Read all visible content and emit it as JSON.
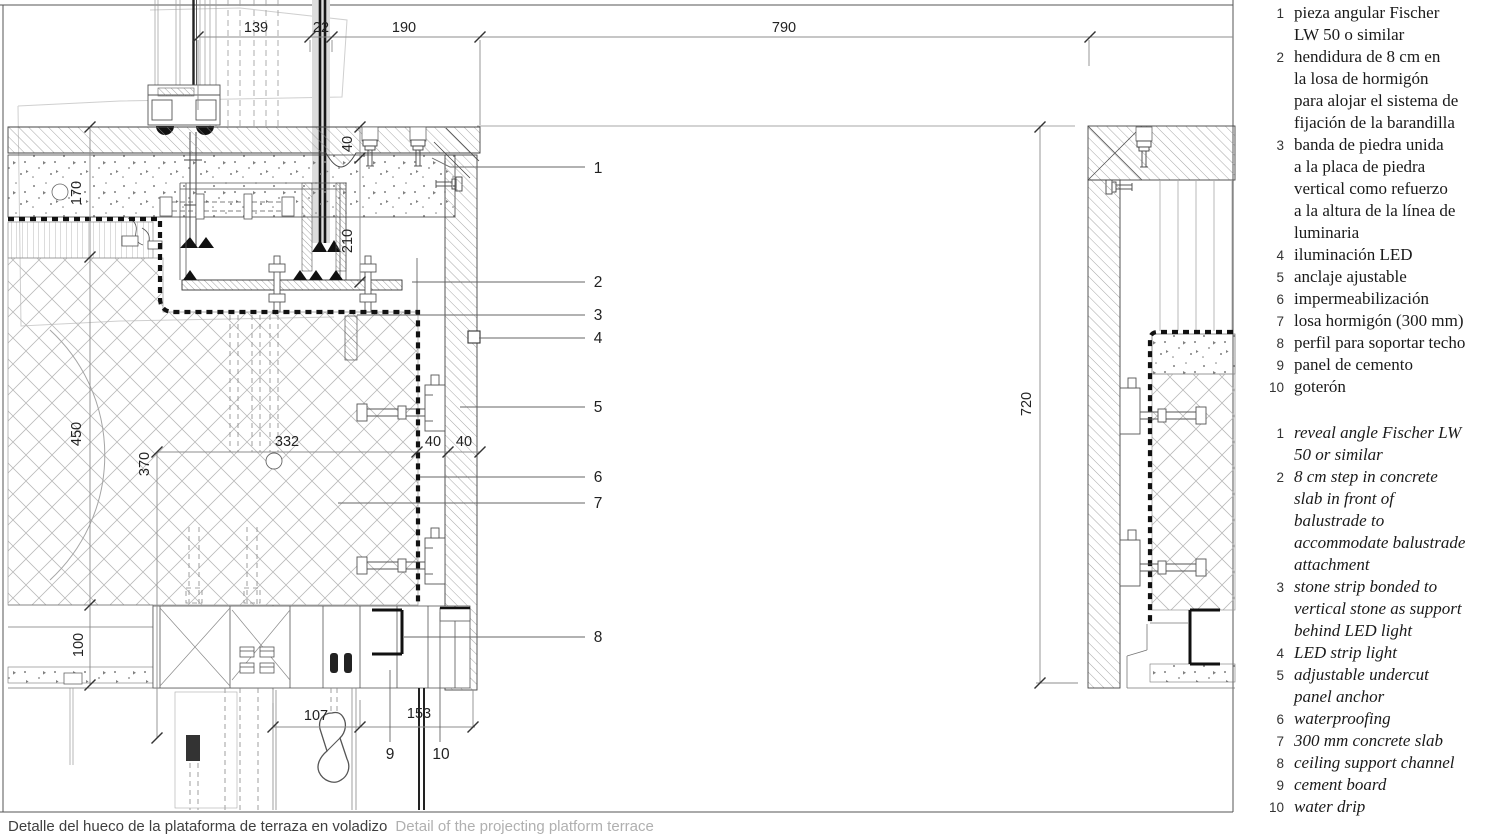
{
  "drawing": {
    "dims": {
      "t139": "139",
      "t22": "22",
      "t190": "190",
      "t790": "790",
      "v40": "40",
      "v210": "210",
      "v170": "170",
      "v450": "450",
      "v370": "370",
      "v100": "100",
      "v720": "720",
      "m332": "332",
      "m40a": "40",
      "m40b": "40",
      "b107": "107",
      "b153": "153"
    },
    "callouts": {
      "c1": "1",
      "c2": "2",
      "c3": "3",
      "c4": "4",
      "c5": "5",
      "c6": "6",
      "c7": "7",
      "c8": "8",
      "c9": "9",
      "c10": "10"
    }
  },
  "legend": {
    "es": {
      "items": [
        {
          "num": "1",
          "text": "pieza angular Fischer\nLW 50 o similar"
        },
        {
          "num": "2",
          "text": "hendidura de 8 cm en\nla losa de hormigón\npara alojar el sistema de\nfijación de la barandilla"
        },
        {
          "num": "3",
          "text": "banda de piedra unida\na la placa de piedra\nvertical como refuerzo\na la altura de la línea de\nluminaria"
        },
        {
          "num": "4",
          "text": "iluminación LED"
        },
        {
          "num": "5",
          "text": "anclaje ajustable"
        },
        {
          "num": "6",
          "text": "impermeabilización"
        },
        {
          "num": "7",
          "text": "losa hormigón (300 mm)"
        },
        {
          "num": "8",
          "text": "perfil para soportar techo"
        },
        {
          "num": "9",
          "text": "panel de cemento"
        },
        {
          "num": "10",
          "text": "goterón"
        }
      ]
    },
    "en": {
      "items": [
        {
          "num": "1",
          "text": "reveal angle Fischer LW\n50 or similar"
        },
        {
          "num": "2",
          "text": "8 cm step in concrete\nslab in front of\nbalustrade to\naccommodate balustrade\nattachment"
        },
        {
          "num": "3",
          "text": "stone strip bonded to\nvertical stone as support\nbehind LED light"
        },
        {
          "num": "4",
          "text": "LED strip light"
        },
        {
          "num": "5",
          "text": "adjustable undercut\npanel anchor"
        },
        {
          "num": "6",
          "text": "waterproofing"
        },
        {
          "num": "7",
          "text": "300 mm concrete slab"
        },
        {
          "num": "8",
          "text": "ceiling support channel"
        },
        {
          "num": "9",
          "text": "cement board"
        },
        {
          "num": "10",
          "text": "water drip"
        }
      ]
    }
  },
  "caption": {
    "es": "Detalle del hueco de la plataforma de terraza en voladizo",
    "en": "Detail of the projecting platform terrace"
  },
  "colors": {
    "line": "#3a3a3a",
    "dim_line": "#8c8c8c",
    "hatch": "#909090",
    "insulation_hatch": "#b8b8b8",
    "waterproofing": "#111111",
    "caption_es": "#3f3f3f",
    "caption_en": "#b0b0b0",
    "background": "#ffffff"
  }
}
